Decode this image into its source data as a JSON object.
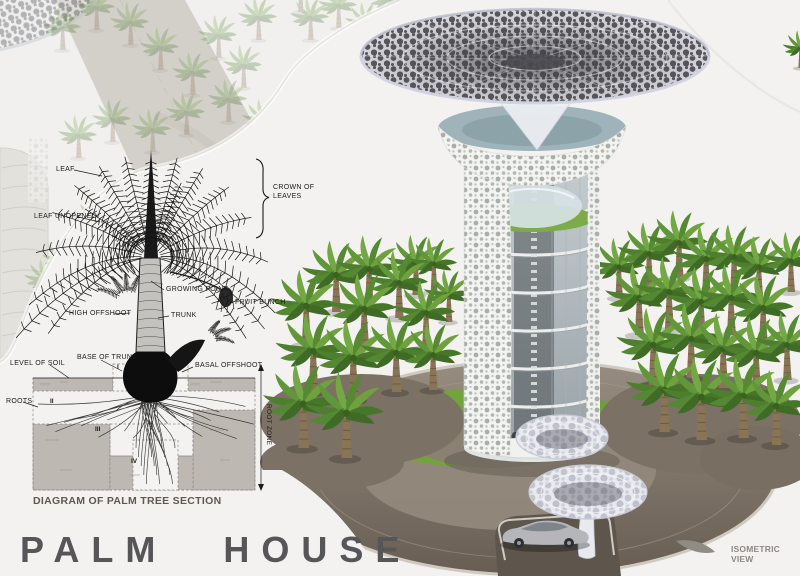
{
  "title": "PALM HOUSE",
  "view_label": "ISOMETRIC VIEW",
  "diagram": {
    "caption": "DIAGRAM OF PALM TREE SECTION",
    "labels": {
      "leaf": "LEAF",
      "leaf_unopened": "LEAF UNOPENED",
      "crown_of_leaves": "CROWN OF LEAVES",
      "growing_point": "GROWING POINT",
      "fruit_bunch": "FRUIT BUNCH",
      "high_offshoot": "HIGH OFFSHOOT",
      "trunk": "TRUNK",
      "base_of_trunk": "BASE OF TRUNK",
      "basal_offshoot": "BASAL OFFSHOOT",
      "level_of_soil": "LEVEL OF SOIL",
      "roots": "ROOTS",
      "root_zone": "ROOT ZONE"
    },
    "zone_numerals": [
      "I",
      "II",
      "III",
      "IV"
    ]
  },
  "colors": {
    "background": "#f1f0ee",
    "title_text": "#565659",
    "caption_text": "#61584f",
    "diagram_ink": "#1b1b1b",
    "plaza_paving": "#8a8073",
    "lawn_green": "#73a43b",
    "palm_green": "#61973a",
    "canopy_hole": "#5a5a60"
  }
}
